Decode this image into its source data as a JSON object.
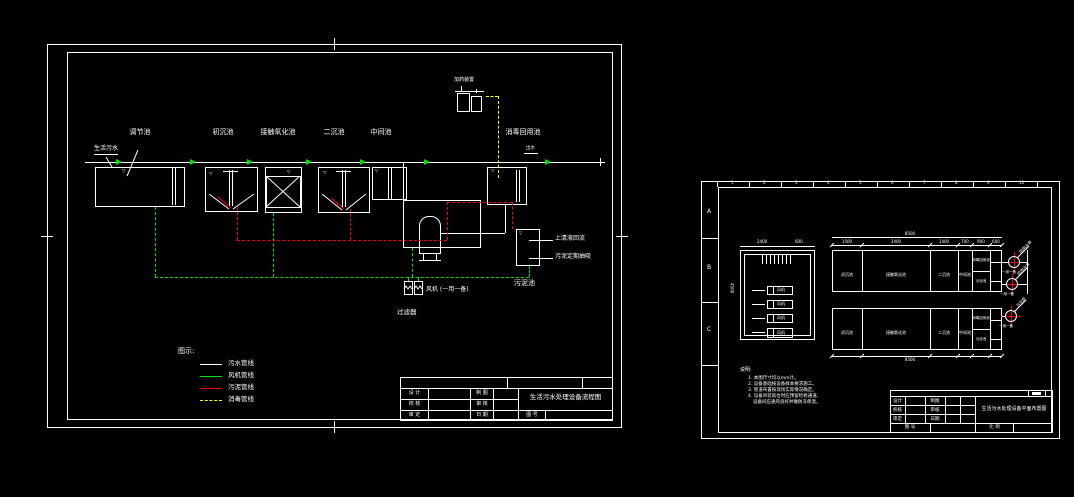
{
  "colors": {
    "line": "#ffffff",
    "air": "#00e400",
    "sludge": "#ff0000",
    "disinfect": "#ffff00",
    "background": "#000000"
  },
  "left_sheet": {
    "inlet_label": "生活污水",
    "outlet_label": "出水",
    "tanks": [
      "调节池",
      "初沉池",
      "接触氧化池",
      "二沉池",
      "中间池",
      "消毒回用池"
    ],
    "dosing_label": "加药装置",
    "filter_label": "过滤器",
    "blower_label": "风机 (一用一备)",
    "sludge_tank_label": "污泥池",
    "level_mark": "▽",
    "callouts": {
      "supernatant": "上清液回流",
      "sludge_out": "污泥定期抽吸"
    },
    "legend": {
      "title": "图示:",
      "items": [
        {
          "label": "污水管线"
        },
        {
          "label": "风机管线"
        },
        {
          "label": "污泥管线"
        },
        {
          "label": "消毒管线"
        }
      ]
    },
    "titleblock": {
      "title": "生活污水处理设备流程图",
      "cells": [
        [
          "设 计",
          "制 图"
        ],
        [
          "校 核",
          "审 核"
        ],
        [
          "审 定",
          "日 期"
        ]
      ],
      "drawing_no": "图 号"
    }
  },
  "right_sheet": {
    "zones": [
      "A",
      "B",
      "C"
    ],
    "ruler": [
      "1",
      "2",
      "3",
      "4",
      "5",
      "6",
      "7",
      "8",
      "9",
      "10"
    ],
    "room": {
      "equipment": [
        "风机",
        "风机",
        "风机",
        "风机"
      ],
      "dims": {
        "top1": "2400",
        "top2": "600",
        "left": "4500"
      }
    },
    "train": {
      "compartments": [
        "初沉池",
        "接触氧化池",
        "二沉池",
        "中间池",
        "消毒回用池",
        "污泥池"
      ],
      "dims": [
        "1500",
        "3400",
        "1400",
        "700",
        "900",
        "600"
      ],
      "overall": "8500"
    },
    "pumps": {
      "labels": [
        "回用水泵",
        "回用水泵",
        "污泥泵"
      ],
      "note": "一用一备"
    },
    "notes": {
      "title": "说明:",
      "lines": [
        "1. 本图尺寸均以mm计。",
        "2. 设备基础按设备样本要求施工。",
        "3. 管道布置按现场实际情况确定。",
        "4. 设备吊装就位时应预留检修通道,",
        "设备间应通风良好并做防冻保温。"
      ]
    },
    "titleblock": {
      "title": "生活污水处理设备平面布置图",
      "cells": [
        [
          "设计",
          "制图"
        ],
        [
          "校核",
          "审核"
        ],
        [
          "审定",
          "日期"
        ]
      ],
      "drawing_no": "图 号",
      "scale_label": "比 例"
    }
  }
}
